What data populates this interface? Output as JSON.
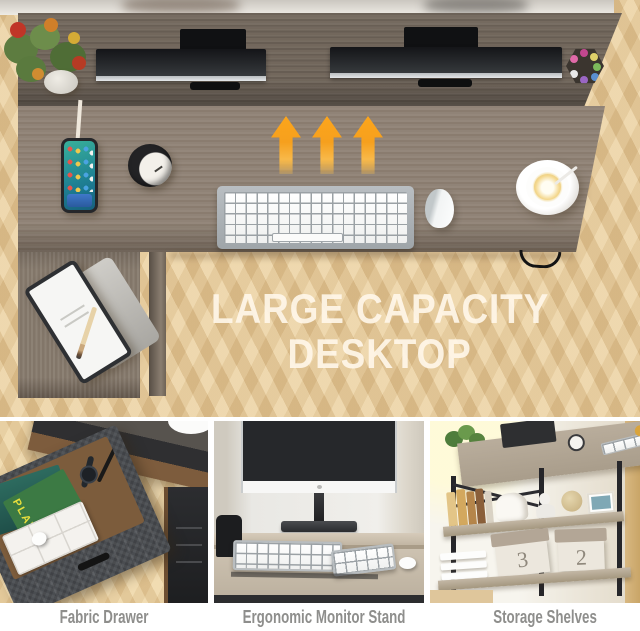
{
  "hero": {
    "title_line1": "LARGE CAPACITY",
    "title_line2": "DESKTOP"
  },
  "features": [
    {
      "caption": "Fabric Drawer",
      "magazine_label": "PLAY"
    },
    {
      "caption": "Ergonomic Monitor Stand"
    },
    {
      "caption": "Storage Shelves",
      "box_label_left": "3",
      "box_label_right": "2"
    }
  ],
  "colors": {
    "arrow_orange": "#F7A41E",
    "desk_wood": "#8E8174",
    "riser_shelf_wood": "#6F6459",
    "floor_wood": "#E8CD9E",
    "caption_text": "#8E8E8C",
    "title_text": "#FFF7EA",
    "fabric_drawer_gray": "#4A4D51"
  }
}
